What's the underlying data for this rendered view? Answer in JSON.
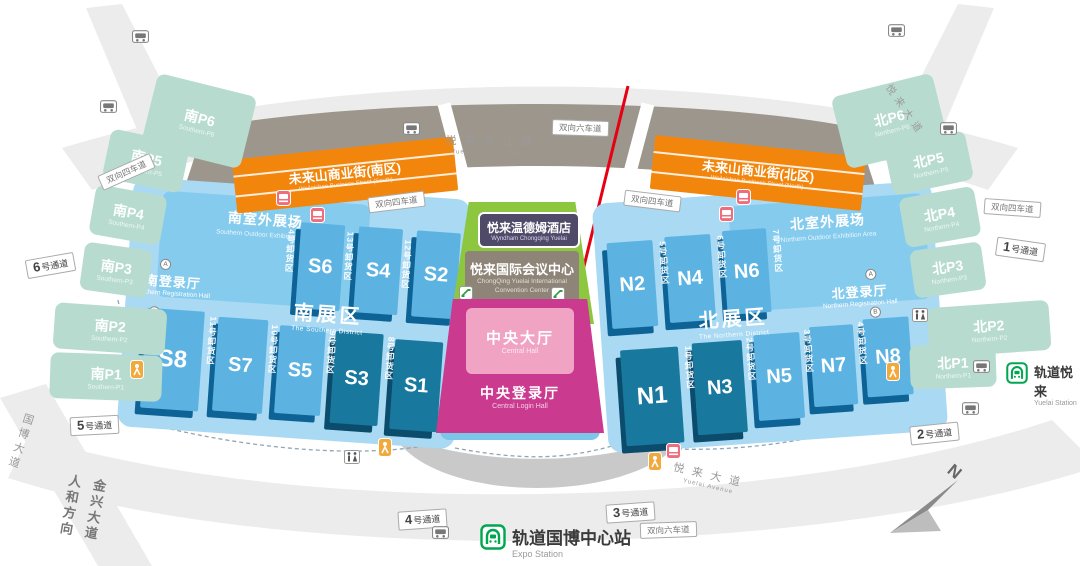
{
  "central": {
    "hotel": {
      "zh": "悦来温德姆酒店",
      "en": "Wyndham Chongqing Yuelai"
    },
    "convention": {
      "zh": "悦来国际会议中心",
      "en1": "ChongQing Yuelai International",
      "en2": "Convention Center"
    },
    "central_hall": {
      "zh": "中央大厅",
      "en": "Central Hall"
    },
    "login_hall": {
      "zh": "中央登录厅",
      "en": "Central Login Hall"
    }
  },
  "south": {
    "outdoor": {
      "zh": "南室外展场",
      "en": "Southern Outdoor Exhibition Area"
    },
    "district": {
      "zh": "南展区",
      "en": "The Southern District"
    },
    "registration": {
      "zh": "南登录厅",
      "en": "Southern Registration Hall"
    },
    "halls_top": [
      "S6",
      "S4",
      "S2"
    ],
    "halls_bottom": [
      "S8",
      "S7",
      "S5",
      "S3",
      "S1"
    ],
    "unloading_top": [
      "14号卸货区",
      "13号卸货区",
      "12号卸货区"
    ],
    "unloading_bottom": [
      "11号卸货区",
      "10号卸货区",
      "9号卸货区",
      "8号卸货区"
    ],
    "street": {
      "zh": "未来山商业街(南区)",
      "en": "Weilaishan Business Street (South)"
    }
  },
  "north": {
    "outdoor": {
      "zh": "北室外展场",
      "en": "Northern Outdoor Exhibition Area"
    },
    "district": {
      "zh": "北展区",
      "en": "The Northern District"
    },
    "registration": {
      "zh": "北登录厅",
      "en": "Northern Registration Hall"
    },
    "halls_top": [
      "N2",
      "N4",
      "N6"
    ],
    "halls_bottom": [
      "N1",
      "N3",
      "N5",
      "N7",
      "N8"
    ],
    "unloading_top": [
      "5号卸货区",
      "6号卸货区",
      "7号卸货区"
    ],
    "unloading_bottom": [
      "1号卸货区",
      "2号卸货区",
      "3号卸货区",
      "4号卸货区"
    ],
    "street": {
      "zh": "未来山商业街(北区)",
      "en": "Weilaishan Business Street (North)"
    }
  },
  "parking": {
    "south": [
      {
        "zh": "南P6",
        "en": "Southern-P6"
      },
      {
        "zh": "南P5",
        "en": "Southern-P5"
      },
      {
        "zh": "南P4",
        "en": "Southern-P4"
      },
      {
        "zh": "南P3",
        "en": "Southern-P3"
      },
      {
        "zh": "南P2",
        "en": "Southern-P2"
      },
      {
        "zh": "南P1",
        "en": "Southern-P1"
      }
    ],
    "north": [
      {
        "zh": "北P6",
        "en": "Northern-P6"
      },
      {
        "zh": "北P5",
        "en": "Northern-P5"
      },
      {
        "zh": "北P4",
        "en": "Northern-P4"
      },
      {
        "zh": "北P3",
        "en": "Northern-P3"
      },
      {
        "zh": "北P2",
        "en": "Northern-P2"
      },
      {
        "zh": "北P1",
        "en": "Northern-P1"
      }
    ]
  },
  "roads": {
    "binjiang": {
      "zh": "悦来滨江路",
      "en": "Yuelai Binjiang Avenue"
    },
    "yuelai": {
      "zh": "悦来大道",
      "en": "Yuelai Avenue"
    },
    "guobo": "国博大道",
    "jinxing_line1": "金兴大道",
    "jinxing_line2": "人和方向",
    "six_lane": "双向六车道",
    "four_lane": "双向四车道"
  },
  "passages": [
    {
      "num": "6",
      "suffix": "号通道"
    },
    {
      "num": "5",
      "suffix": "号通道"
    },
    {
      "num": "4",
      "suffix": "号通道"
    },
    {
      "num": "3",
      "suffix": "号通道"
    },
    {
      "num": "2",
      "suffix": "号通道"
    },
    {
      "num": "1",
      "suffix": "号通道"
    }
  ],
  "stations": {
    "expo": {
      "zh": "轨道国博中心站",
      "en": "Expo Station"
    },
    "yuelai": {
      "zh": "轨道悦来",
      "en": "Yuelai Station"
    }
  },
  "badges": {
    "a": "A",
    "b": "B"
  },
  "compass": {
    "label": "N"
  },
  "colors": {
    "hall_light": "#5cb3e2",
    "hall_dark": "#19789e",
    "platform": "#a9d9f3",
    "outdoor": "#85cbee",
    "parking": "#b7dccf",
    "street_orange": "#f2860d",
    "convention_green": "#8dc63f",
    "hall_pink": "#f0a3c3",
    "login_magenta": "#ca3a8e",
    "building_gray": "#9d968c",
    "metro_green": "#00a650",
    "arrow_red": "#e60012"
  }
}
